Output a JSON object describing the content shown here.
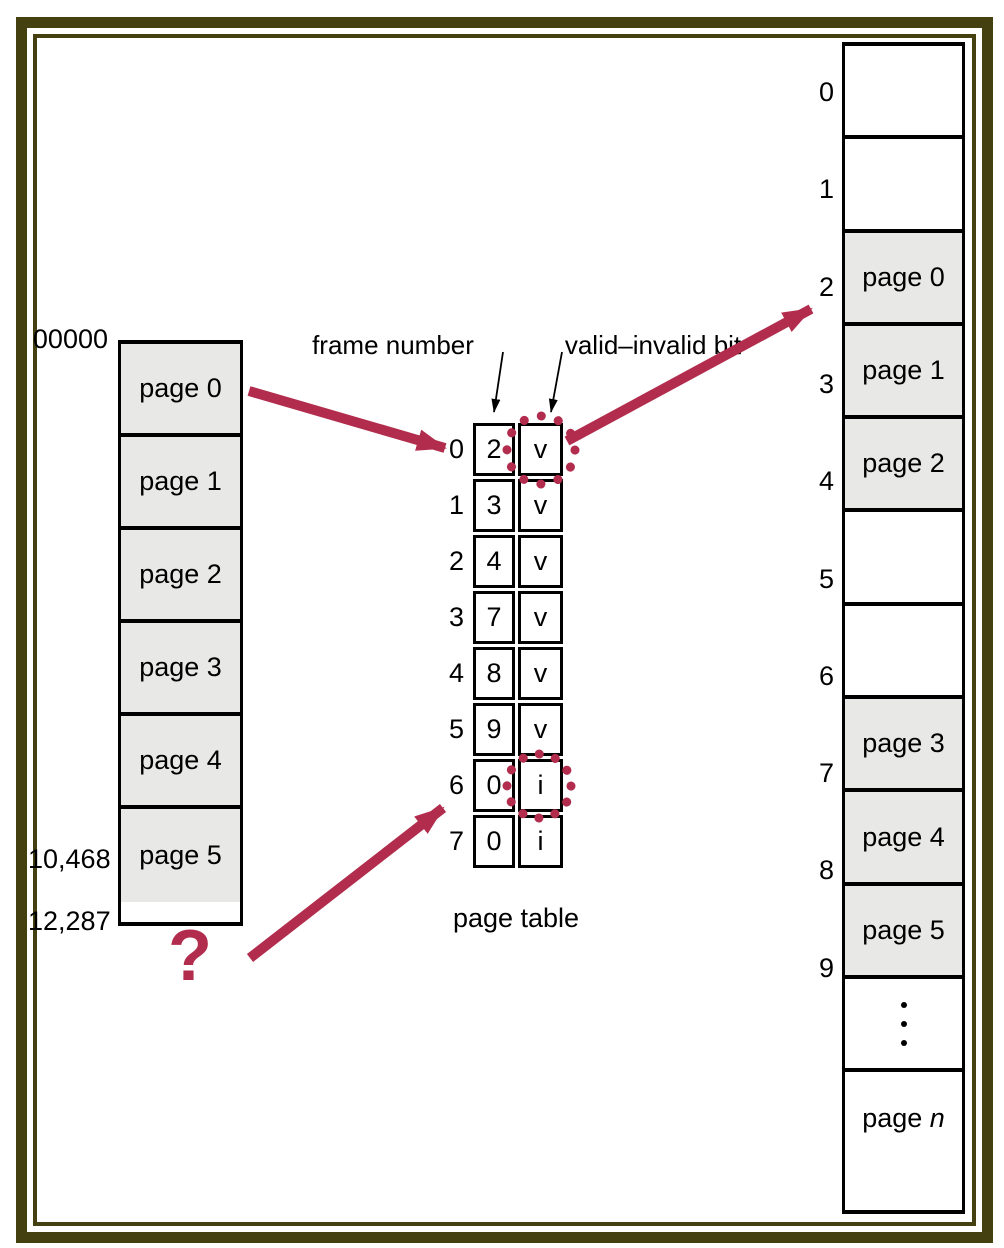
{
  "colors": {
    "accent_red": "#b22d4d",
    "frame_olive": "#454010",
    "cell_gray": "#e8e8e6"
  },
  "logical_memory": {
    "address_top": "00000",
    "address_mid": "10,468",
    "address_bottom": "12,287",
    "pages": [
      "page 0",
      "page 1",
      "page 2",
      "page 3",
      "page 4",
      "page 5"
    ]
  },
  "page_table": {
    "caption": "page table",
    "frame_number_label": "frame number",
    "valid_invalid_label": "valid–invalid bit",
    "rows": [
      {
        "index": "0",
        "frame": "2",
        "bit": "v"
      },
      {
        "index": "1",
        "frame": "3",
        "bit": "v"
      },
      {
        "index": "2",
        "frame": "4",
        "bit": "v"
      },
      {
        "index": "3",
        "frame": "7",
        "bit": "v"
      },
      {
        "index": "4",
        "frame": "8",
        "bit": "v"
      },
      {
        "index": "5",
        "frame": "9",
        "bit": "v"
      },
      {
        "index": "6",
        "frame": "0",
        "bit": "i"
      },
      {
        "index": "7",
        "frame": "0",
        "bit": "i"
      }
    ]
  },
  "physical_memory": {
    "frames": [
      {
        "index": "0",
        "content": ""
      },
      {
        "index": "1",
        "content": ""
      },
      {
        "index": "2",
        "content": "page 0"
      },
      {
        "index": "3",
        "content": "page 1"
      },
      {
        "index": "4",
        "content": "page 2"
      },
      {
        "index": "5",
        "content": ""
      },
      {
        "index": "6",
        "content": ""
      },
      {
        "index": "7",
        "content": "page 3"
      },
      {
        "index": "8",
        "content": "page 4"
      },
      {
        "index": "9",
        "content": "page 5"
      },
      {
        "index": "",
        "content": "",
        "icon": "vertical-ellipsis"
      },
      {
        "index": "",
        "content_prefix": "page ",
        "content_italic": "n"
      }
    ]
  },
  "annotations": {
    "question_mark": "?"
  }
}
